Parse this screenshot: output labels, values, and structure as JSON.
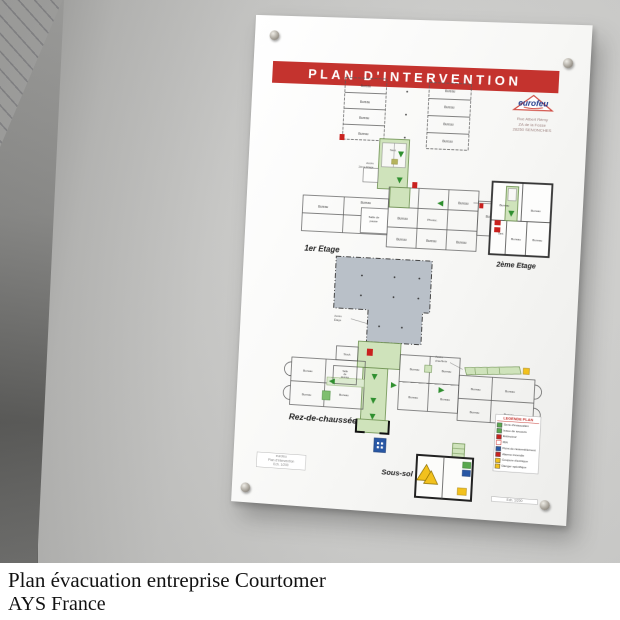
{
  "caption": {
    "line1": "Plan évacuation entreprise Courtomer",
    "line2": "AYS France"
  },
  "panel": {
    "title": "PLAN D'INTERVENTION",
    "logo": {
      "name": "eurofeu",
      "address": [
        "Rue Albert Rémy",
        "ZA de la Fosse",
        "28250 SENONCHES"
      ]
    },
    "floors": {
      "first": "1er Etage",
      "second": "2ème Etage",
      "ground": "Rez-de-chaussée",
      "basement": "Sous-sol"
    },
    "rooms": {
      "office": "Bureau",
      "break_room": [
        "Salle de",
        "pause"
      ],
      "meeting_room": [
        "Salle de",
        "réunion"
      ],
      "meeting_room_v": [
        "Salle",
        "de",
        "réunion"
      ],
      "photocopy": "Photoc.",
      "stock": "Stock",
      "sanitary": "Sani."
    },
    "annotations": {
      "access_second_floor": [
        "Accès",
        "2ème Etage"
      ],
      "access_floor": [
        "Accès",
        "Étage"
      ],
      "access_boiler": [
        "Accès",
        "chaufferie"
      ]
    },
    "legend": {
      "title": "LEGENDE PLAN",
      "items": [
        {
          "color": "#59a84e",
          "label": "Sens d'évacuation"
        },
        {
          "color": "#59a84e",
          "label": "Issue de secours"
        },
        {
          "color": "#c9211e",
          "label": "Extincteur"
        },
        {
          "color": "#c9211e",
          "label": "RIA"
        },
        {
          "color": "#2857a4",
          "label": "Point de rassemblement"
        },
        {
          "color": "#c9211e",
          "label": "Alarme incendie"
        },
        {
          "color": "#f2c11d",
          "label": "Coupure électrique"
        },
        {
          "color": "#f2c11d",
          "label": "Danger spécifique"
        }
      ],
      "footer": "Ech. 1/200"
    },
    "cartouche": [
      "eurofeu",
      "Plan d'intervention",
      "Ech. 1/200"
    ]
  },
  "colors": {
    "banner_red": "#c4332e",
    "corridor_green": "#cfe3bb",
    "alarm_red": "#c9211e",
    "info_blue": "#2857a4",
    "warning_yellow": "#f2c11d",
    "hall_gray": "#b9c0c8"
  }
}
